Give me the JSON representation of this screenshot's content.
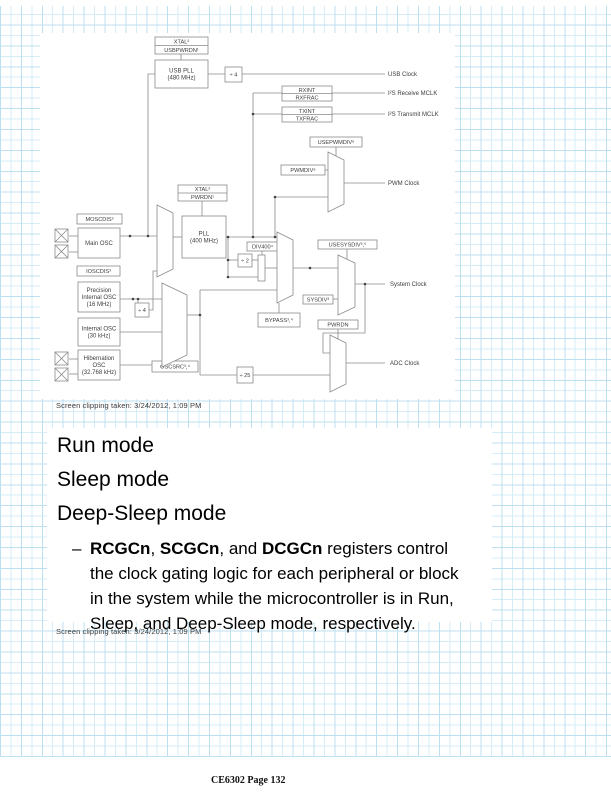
{
  "colors": {
    "grid_light": "#d7ecf9",
    "grid_dark": "#bcdff2",
    "diagram_stroke": "#8a8a8a",
    "diagram_text": "#3d3d3d",
    "caption_text": "#3c3c3c",
    "dot_color": "#444444"
  },
  "captions": {
    "clip1": "Screen clipping taken: 3/24/2012, 1:09 PM",
    "clip2": "Screen clipping taken: 3/24/2012, 1:09 PM"
  },
  "notes": {
    "heading1": "Run mode",
    "heading2": "Sleep mode",
    "heading3": "Deep-Sleep mode",
    "bullet_dash": "–",
    "bullet_lines": [
      [
        {
          "t": "RCGCn",
          "b": true
        },
        {
          "t": ", ",
          "b": false
        },
        {
          "t": "SCGCn",
          "b": true
        },
        {
          "t": ", and ",
          "b": false
        },
        {
          "t": "DCGCn",
          "b": true
        },
        {
          "t": " registers control",
          "b": false
        }
      ],
      [
        {
          "t": "the clock gating logic for each peripheral or block",
          "b": false
        }
      ],
      [
        {
          "t": "in the system while the microcontroller is in Run,",
          "b": false
        }
      ],
      [
        {
          "t": "Sleep, and Deep-Sleep mode, respectively.",
          "b": false
        }
      ]
    ]
  },
  "footer": {
    "text": "CE6302 Page 132"
  },
  "diagram": {
    "boxes": [
      {
        "id": "xtal-usbpwrdn-label",
        "type": "stack",
        "x": 115,
        "y": 4,
        "w": 53,
        "h": 17,
        "lines": [
          "XTAL²",
          "USBPWRDN¹"
        ]
      },
      {
        "id": "usb-pll-block",
        "type": "block",
        "x": 115,
        "y": 27,
        "w": 53,
        "h": 28,
        "lines": [
          "USB PLL",
          "(480 MHz)"
        ]
      },
      {
        "id": "usb-div4-block",
        "type": "div",
        "x": 185,
        "y": 34,
        "w": 17,
        "h": 15,
        "lines": [
          "÷ 4"
        ]
      },
      {
        "id": "rxint-label",
        "type": "stack",
        "x": 242,
        "y": 53,
        "w": 50,
        "h": 15,
        "lines": [
          "RXINT",
          "RXFRAC"
        ]
      },
      {
        "id": "txint-label",
        "type": "stack",
        "x": 242,
        "y": 74,
        "w": 50,
        "h": 15,
        "lines": [
          "TXINT",
          "TXFRAC"
        ]
      },
      {
        "id": "usepwmdiv-label",
        "type": "label",
        "x": 270,
        "y": 104,
        "w": 52,
        "h": 10,
        "lines": [
          "USEPWMDIV⁶"
        ]
      },
      {
        "id": "pwmdiv-label",
        "type": "label",
        "x": 241,
        "y": 132,
        "w": 44,
        "h": 10,
        "lines": [
          "PWMDIV⁶"
        ]
      },
      {
        "id": "xtal-pwrdn-label",
        "type": "stack",
        "x": 138,
        "y": 152,
        "w": 49,
        "h": 16,
        "lines": [
          "XTAL²",
          "PWRDN¹"
        ]
      },
      {
        "id": "pll-block",
        "type": "block",
        "x": 142,
        "y": 183,
        "w": 44,
        "h": 42,
        "lines": [
          "PLL",
          "(400 MHz)"
        ]
      },
      {
        "id": "moscdis-label",
        "type": "label",
        "x": 37,
        "y": 181,
        "w": 45,
        "h": 10,
        "lines": [
          "MOSCDIS³"
        ]
      },
      {
        "id": "main-osc-block",
        "type": "block",
        "x": 38,
        "y": 195,
        "w": 42,
        "h": 30,
        "lines": [
          "Main OSC"
        ]
      },
      {
        "id": "ioscdis-label",
        "type": "label",
        "x": 37,
        "y": 233,
        "w": 43,
        "h": 10,
        "lines": [
          "IOSCDIS³"
        ]
      },
      {
        "id": "precision-osc-block",
        "type": "block",
        "x": 38,
        "y": 249,
        "w": 42,
        "h": 30,
        "lines": [
          "Precision",
          "Internal OSC",
          "(16 MHz)"
        ]
      },
      {
        "id": "piosc-div4-block",
        "type": "div",
        "x": 95,
        "y": 270,
        "w": 14,
        "h": 14,
        "lines": [
          "÷ 4"
        ]
      },
      {
        "id": "internal-osc-block",
        "type": "block",
        "x": 38,
        "y": 285,
        "w": 42,
        "h": 28,
        "lines": [
          "Internal OSC",
          "(30 kHz)"
        ]
      },
      {
        "id": "hibernation-osc-block",
        "type": "block",
        "x": 38,
        "y": 317,
        "w": 42,
        "h": 30,
        "lines": [
          "Hibernation",
          "OSC",
          "(32.768 kHz)"
        ]
      },
      {
        "id": "oscsrc-label",
        "type": "label",
        "x": 112,
        "y": 328,
        "w": 46,
        "h": 11,
        "lines": [
          "OSCSRC³,⁴"
        ]
      },
      {
        "id": "div400-label",
        "type": "label",
        "x": 207,
        "y": 209,
        "w": 31,
        "h": 9,
        "lines": [
          "DIV400⁴"
        ]
      },
      {
        "id": "div2-block",
        "type": "div",
        "x": 198,
        "y": 221,
        "w": 14,
        "h": 13,
        "lines": [
          "÷ 2"
        ]
      },
      {
        "id": "divsel-rect",
        "type": "rect",
        "x": 218,
        "y": 222,
        "w": 7,
        "h": 26,
        "lines": []
      },
      {
        "id": "usesysdiv-label",
        "type": "label",
        "x": 278,
        "y": 207,
        "w": 59,
        "h": 9,
        "lines": [
          "USESYSDIV³,⁵"
        ]
      },
      {
        "id": "sysdiv-label",
        "type": "label",
        "x": 263,
        "y": 262,
        "w": 30,
        "h": 9,
        "lines": [
          "SYSDIV³"
        ]
      },
      {
        "id": "bypass-label",
        "type": "label",
        "x": 218,
        "y": 280,
        "w": 42,
        "h": 14,
        "lines": [
          "BYPASS³,⁴"
        ]
      },
      {
        "id": "pwrdn-label",
        "type": "label",
        "x": 278,
        "y": 287,
        "w": 40,
        "h": 9,
        "lines": [
          "PWRDN"
        ]
      },
      {
        "id": "div25-block",
        "type": "div",
        "x": 197,
        "y": 334,
        "w": 16,
        "h": 16,
        "lines": [
          "÷ 25"
        ]
      }
    ],
    "muxes": [
      {
        "id": "pwm-mux",
        "points": "288,119 304,127 304,171 288,179"
      },
      {
        "id": "pll-src-mux",
        "points": "117,172 133,180 133,236 117,244"
      },
      {
        "id": "osc-src-mux",
        "points": "122,250 147,262 147,322 122,334"
      },
      {
        "id": "div-sel-mux",
        "points": "237,199 253,207 253,262 237,270"
      },
      {
        "id": "sysclk-mux",
        "points": "298,222 315,230 315,274 298,282"
      },
      {
        "id": "adc-mux",
        "points": "290,302 306,310 306,351 290,359"
      }
    ],
    "xpins": [
      [
        15,
        196
      ],
      [
        15,
        212
      ],
      [
        15,
        319
      ],
      [
        15,
        335
      ]
    ],
    "wires": [
      [
        [
          141,
          20
        ],
        [
          141,
          27
        ]
      ],
      [
        [
          168,
          41
        ],
        [
          185,
          41
        ]
      ],
      [
        [
          202,
          41
        ],
        [
          345,
          41
        ]
      ],
      [
        [
          115,
          41
        ],
        [
          108,
          41
        ],
        [
          108,
          203
        ]
      ],
      [
        [
          80,
          203
        ],
        [
          117,
          203
        ]
      ],
      [
        [
          80,
          266
        ],
        [
          122,
          266
        ]
      ],
      [
        [
          98,
          266
        ],
        [
          98,
          270
        ]
      ],
      [
        [
          109,
          277
        ],
        [
          113,
          277
        ],
        [
          113,
          238
        ],
        [
          117,
          238
        ]
      ],
      [
        [
          80,
          299
        ],
        [
          122,
          299
        ]
      ],
      [
        [
          80,
          332
        ],
        [
          122,
          332
        ]
      ],
      [
        [
          133,
          204
        ],
        [
          142,
          204
        ]
      ],
      [
        [
          162,
          168
        ],
        [
          162,
          183
        ]
      ],
      [
        [
          186,
          204
        ],
        [
          237,
          204
        ]
      ],
      [
        [
          188,
          204
        ],
        [
          188,
          244
        ]
      ],
      [
        [
          188,
          227
        ],
        [
          198,
          227
        ]
      ],
      [
        [
          212,
          227
        ],
        [
          218,
          227
        ]
      ],
      [
        [
          188,
          244
        ],
        [
          218,
          244
        ]
      ],
      [
        [
          222,
          218
        ],
        [
          222,
          222
        ]
      ],
      [
        [
          225,
          235
        ],
        [
          237,
          235
        ]
      ],
      [
        [
          213,
          60
        ],
        [
          213,
          204
        ]
      ],
      [
        [
          213,
          60
        ],
        [
          242,
          60
        ]
      ],
      [
        [
          213,
          81
        ],
        [
          242,
          81
        ]
      ],
      [
        [
          292,
          60
        ],
        [
          345,
          60
        ]
      ],
      [
        [
          292,
          81
        ],
        [
          345,
          81
        ]
      ],
      [
        [
          235,
          164
        ],
        [
          235,
          204
        ]
      ],
      [
        [
          235,
          164
        ],
        [
          288,
          164
        ]
      ],
      [
        [
          285,
          137
        ],
        [
          288,
          137
        ]
      ],
      [
        [
          296,
          114
        ],
        [
          296,
          123
        ]
      ],
      [
        [
          304,
          150
        ],
        [
          345,
          150
        ]
      ],
      [
        [
          147,
          282
        ],
        [
          160,
          282
        ]
      ],
      [
        [
          160,
          257
        ],
        [
          160,
          342
        ]
      ],
      [
        [
          160,
          257
        ],
        [
          237,
          257
        ]
      ],
      [
        [
          160,
          342
        ],
        [
          197,
          342
        ]
      ],
      [
        [
          135,
          324
        ],
        [
          135,
          328
        ]
      ],
      [
        [
          253,
          235
        ],
        [
          298,
          235
        ]
      ],
      [
        [
          293,
          266
        ],
        [
          298,
          266
        ]
      ],
      [
        [
          307,
          216
        ],
        [
          307,
          226
        ]
      ],
      [
        [
          239,
          280
        ],
        [
          239,
          270
        ]
      ],
      [
        [
          315,
          251
        ],
        [
          345,
          251
        ]
      ],
      [
        [
          325,
          251
        ],
        [
          325,
          300
        ],
        [
          283,
          300
        ],
        [
          283,
          320
        ],
        [
          290,
          320
        ]
      ],
      [
        [
          298,
          296
        ],
        [
          298,
          306
        ]
      ],
      [
        [
          213,
          342
        ],
        [
          290,
          342
        ]
      ],
      [
        [
          306,
          330
        ],
        [
          345,
          330
        ]
      ],
      [
        [
          29,
          203
        ],
        [
          38,
          203
        ]
      ],
      [
        [
          29,
          219
        ],
        [
          38,
          219
        ]
      ],
      [
        [
          29,
          326
        ],
        [
          38,
          326
        ]
      ],
      [
        [
          29,
          341
        ],
        [
          38,
          341
        ]
      ]
    ],
    "dots": [
      [
        90,
        203
      ],
      [
        108,
        203
      ],
      [
        93,
        266
      ],
      [
        98,
        266
      ],
      [
        188,
        204
      ],
      [
        188,
        227
      ],
      [
        188,
        244
      ],
      [
        213,
        81
      ],
      [
        213,
        204
      ],
      [
        235,
        164
      ],
      [
        235,
        204
      ],
      [
        270,
        235
      ],
      [
        325,
        251
      ],
      [
        160,
        282
      ]
    ],
    "outputs": [
      {
        "id": "usb-clock",
        "label": "USB Clock",
        "x": 348,
        "y": 41
      },
      {
        "id": "i2s-receive-mclk",
        "label": "I²S Receive MCLK",
        "x": 348,
        "y": 60
      },
      {
        "id": "i2s-transmit-mclk",
        "label": "I²S Transmit MCLK",
        "x": 348,
        "y": 81
      },
      {
        "id": "pwm-clock",
        "label": "PWM Clock",
        "x": 348,
        "y": 150
      },
      {
        "id": "system-clock",
        "label": "System Clock",
        "x": 350,
        "y": 251
      },
      {
        "id": "adc-clock",
        "label": "ADC Clock",
        "x": 350,
        "y": 330
      }
    ]
  }
}
